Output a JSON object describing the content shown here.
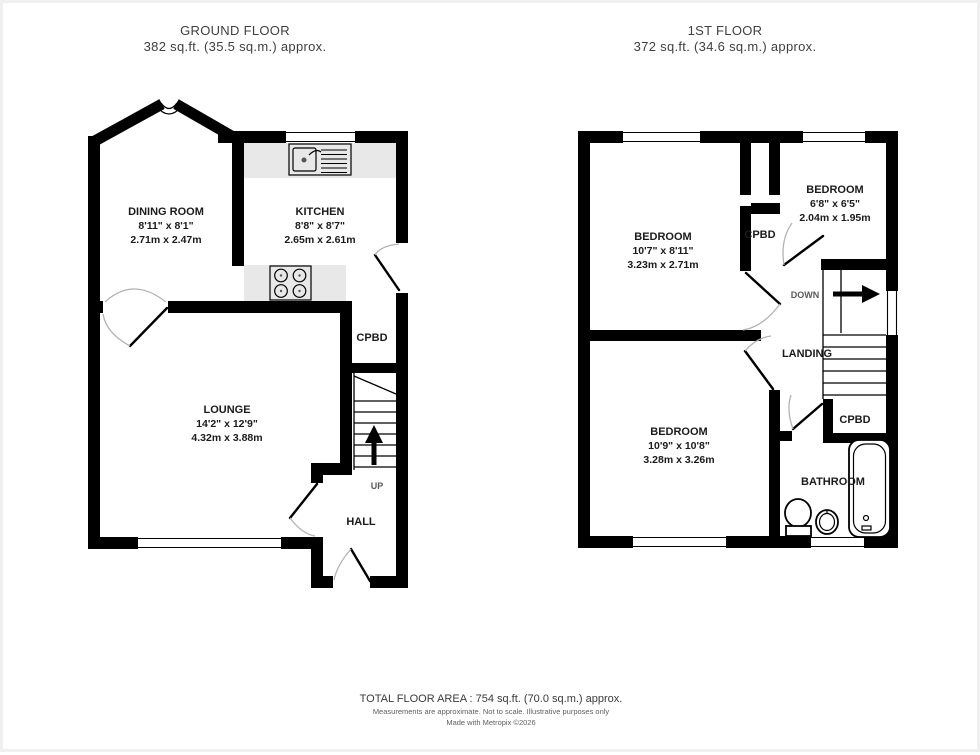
{
  "titles": {
    "ground": {
      "title": "GROUND FLOOR",
      "subtitle": "382 sq.ft. (35.5 sq.m.) approx."
    },
    "first": {
      "title": "1ST FLOOR",
      "subtitle": "372 sq.ft. (34.6 sq.m.) approx."
    }
  },
  "ground_floor": {
    "dining_room": {
      "name": "DINING ROOM",
      "imperial": "8'11\" x 8'1\"",
      "metric": "2.71m x 2.47m"
    },
    "kitchen": {
      "name": "KITCHEN",
      "imperial": "8'8\" x 8'7\"",
      "metric": "2.65m x 2.61m"
    },
    "lounge": {
      "name": "LOUNGE",
      "imperial": "14'2\" x 12'9\"",
      "metric": "4.32m x 3.88m"
    },
    "hall": {
      "name": "HALL"
    },
    "cupboard": {
      "name": "CPBD"
    },
    "stairs": {
      "label": "UP"
    }
  },
  "first_floor": {
    "bedroom_1": {
      "name": "BEDROOM",
      "imperial": "10'7\" x 8'11\"",
      "metric": "3.23m x 2.71m"
    },
    "bedroom_2": {
      "name": "BEDROOM",
      "imperial": "6'8\" x 6'5\"",
      "metric": "2.04m x 1.95m"
    },
    "bedroom_3": {
      "name": "BEDROOM",
      "imperial": "10'9\" x 10'8\"",
      "metric": "3.28m x 3.26m"
    },
    "landing": {
      "name": "LANDING"
    },
    "cupboard_top": {
      "name": "CPBD"
    },
    "cupboard_bottom": {
      "name": "CPBD"
    },
    "bathroom": {
      "name": "BATHROOM"
    },
    "stairs": {
      "label": "DOWN"
    }
  },
  "footer": {
    "total_area": "TOTAL FLOOR AREA : 754 sq.ft. (70.0 sq.m.) approx.",
    "disclaimer": "Measurements are approximate.  Not to scale.  Illustrative purposes only",
    "credit": "Made with Metropix ©2026"
  },
  "colors": {
    "wall": "#000000",
    "counter": "#e8e8e8",
    "door_arc": "#b3b3b3",
    "label_text": "#1b1b1b",
    "title_text": "#404040",
    "stair_text": "#5a5a5a"
  }
}
